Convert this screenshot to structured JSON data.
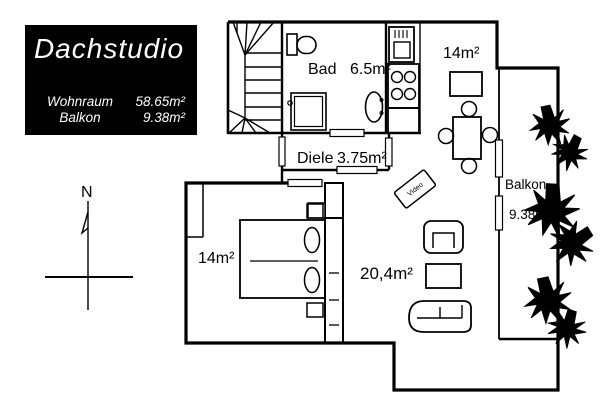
{
  "legend": {
    "title": "Dachstudio",
    "rows": [
      {
        "label": "Wohnraum",
        "value": "58.65m²"
      },
      {
        "label": "Balkon",
        "value": "9.38m²"
      }
    ]
  },
  "compass": {
    "north": "N"
  },
  "rooms": {
    "bad": {
      "name": "Bad",
      "area": "6.5m²"
    },
    "kueche": {
      "area": "14m²"
    },
    "diele": {
      "name": "Diele",
      "area": "3.75m²"
    },
    "schlafzimmer": {
      "area": "14m²"
    },
    "wohnzimmer": {
      "area": "20,4m²"
    },
    "balkon": {
      "name": "Balkon",
      "area": "9.38m²"
    }
  },
  "furniture": {
    "tv_label": "Video"
  },
  "colors": {
    "background": "#ffffff",
    "line": "#000000",
    "legend_bg": "#000000",
    "legend_text": "#ffffff"
  }
}
